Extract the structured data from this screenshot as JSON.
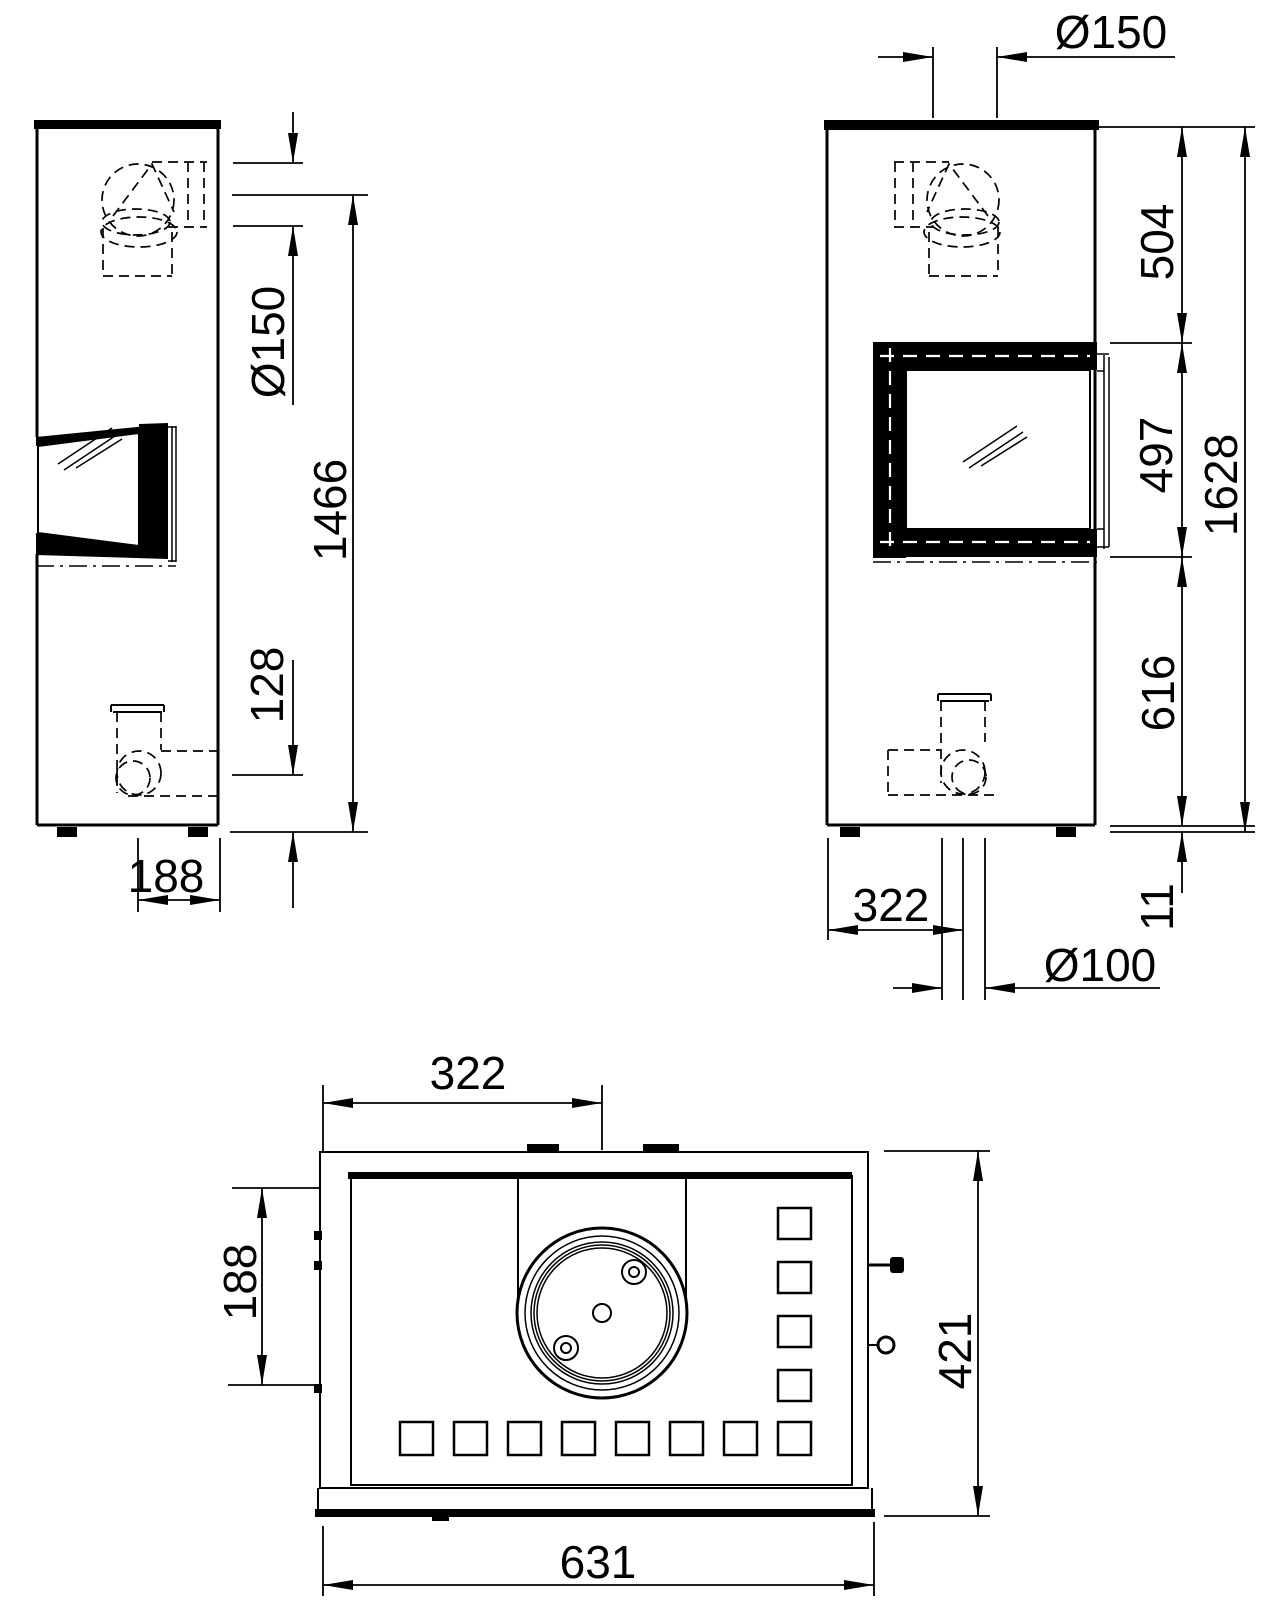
{
  "drawing": {
    "kind": "stove-dimensional-drawing",
    "background": "#ffffff",
    "line_color": "#000000",
    "views": {
      "side_left": {
        "label": "left-side-elevation",
        "dims": {
          "flue_diameter": "Ø150",
          "flue_outlet_height": "1466",
          "air_inlet_height": "128",
          "air_inlet_depth": "188"
        }
      },
      "side_right": {
        "label": "right-side-elevation",
        "dims": {
          "flue_diameter": "Ø150",
          "top_to_door": "504",
          "door_height": "497",
          "total_height": "1628",
          "door_to_floor": "616",
          "foot_height": "11",
          "air_inlet_offset": "322",
          "air_inlet_diameter": "Ø100"
        }
      },
      "top": {
        "label": "top-view",
        "dims": {
          "flue_center_offset": "322",
          "flue_depth_offset": "188",
          "depth": "421",
          "width": "631"
        }
      }
    }
  }
}
